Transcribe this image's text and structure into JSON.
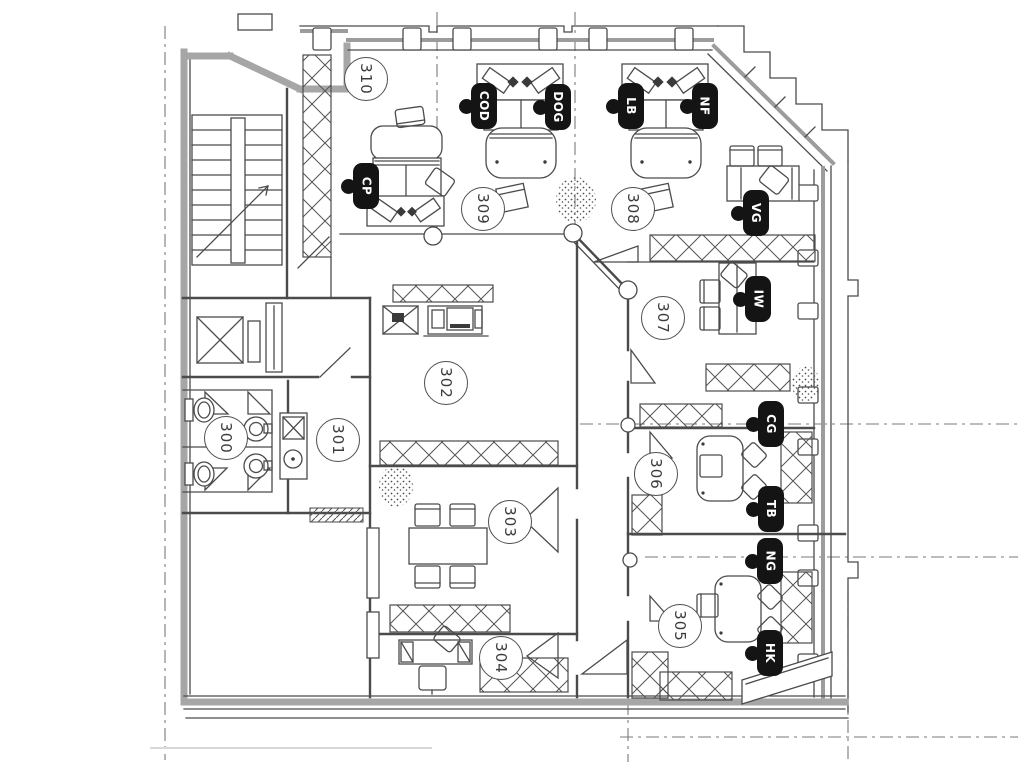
{
  "plan": {
    "rooms": [
      {
        "number": "300"
      },
      {
        "number": "301"
      },
      {
        "number": "302"
      },
      {
        "number": "303"
      },
      {
        "number": "304"
      },
      {
        "number": "305"
      },
      {
        "number": "306"
      },
      {
        "number": "307"
      },
      {
        "number": "308"
      },
      {
        "number": "309"
      },
      {
        "number": "310"
      }
    ],
    "people": [
      {
        "initials": "CP"
      },
      {
        "initials": "COD"
      },
      {
        "initials": "DOG"
      },
      {
        "initials": "LB"
      },
      {
        "initials": "NF"
      },
      {
        "initials": "VG"
      },
      {
        "initials": "IW"
      },
      {
        "initials": "CG"
      },
      {
        "initials": "TB"
      },
      {
        "initials": "NG"
      },
      {
        "initials": "HK"
      }
    ],
    "colors": {
      "ink": "#4b4b4b",
      "wall_gray": "#a6a6a6",
      "badge_black": "#141414",
      "paper": "#ffffff"
    }
  }
}
